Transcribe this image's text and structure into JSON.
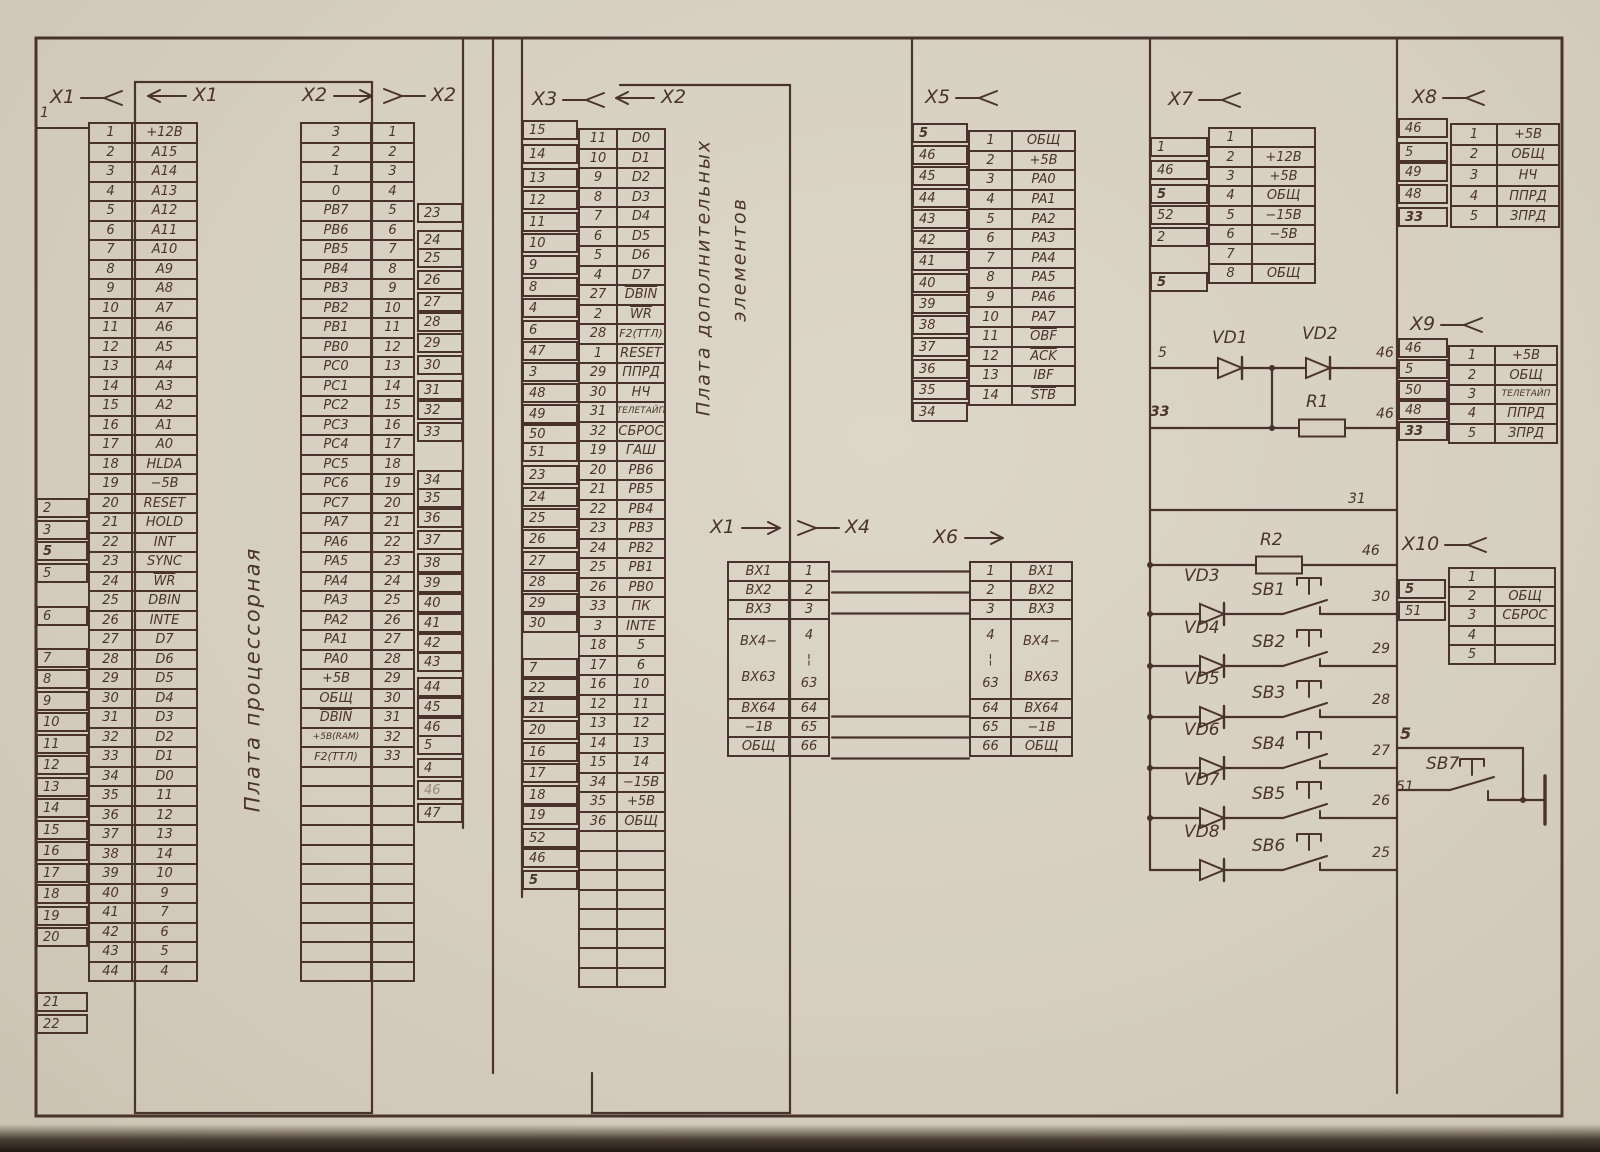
{
  "page": {
    "ink": "#4a332c",
    "paper": "#d8d1c2"
  },
  "boards": {
    "b1": "Плата  процессорная",
    "b2a": "Плата  дополнительных",
    "b2b": "элементов"
  },
  "headers": {
    "x1_out": "X1",
    "x1_in": "X1",
    "x2_in": "X2",
    "x2_mate": "X2",
    "x3_out": "X3",
    "x3_in": "X2",
    "x5": "X5",
    "x7": "X7",
    "x8": "X8",
    "x9": "X9",
    "x10": "X10",
    "x4_src": "X1",
    "x4_mate": "X4",
    "x6": "X6"
  },
  "connectors": {
    "x1": {
      "edge_top": "1",
      "edges": [
        "2",
        "3",
        "*5",
        "5",
        "6",
        "7",
        "8",
        "9",
        "10",
        "11",
        "12",
        "13",
        "14",
        "15",
        "16",
        "17",
        "18",
        "19",
        "20",
        "21",
        "22"
      ],
      "rows": [
        [
          "1",
          "+12В"
        ],
        [
          "2",
          "A15"
        ],
        [
          "3",
          "A14"
        ],
        [
          "4",
          "A13"
        ],
        [
          "5",
          "A12"
        ],
        [
          "6",
          "A11"
        ],
        [
          "7",
          "A10"
        ],
        [
          "8",
          "A9"
        ],
        [
          "9",
          "A8"
        ],
        [
          "10",
          "A7"
        ],
        [
          "11",
          "A6"
        ],
        [
          "12",
          "A5"
        ],
        [
          "13",
          "A4"
        ],
        [
          "14",
          "A3"
        ],
        [
          "15",
          "A2"
        ],
        [
          "16",
          "A1"
        ],
        [
          "17",
          "A0"
        ],
        [
          "18",
          "HLDA"
        ],
        [
          "19",
          "−5В"
        ],
        [
          "20",
          "RESET"
        ],
        [
          "21",
          "HOLD"
        ],
        [
          "22",
          "INT"
        ],
        [
          "23",
          "SYNC"
        ],
        [
          "24",
          "^WR"
        ],
        [
          "25",
          "DBIN"
        ],
        [
          "26",
          "INTE"
        ],
        [
          "27",
          "D7"
        ],
        [
          "28",
          "D6"
        ],
        [
          "29",
          "D5"
        ],
        [
          "30",
          "D4"
        ],
        [
          "31",
          "D3"
        ],
        [
          "32",
          "D2"
        ],
        [
          "33",
          "D1"
        ],
        [
          "34",
          "D0"
        ],
        [
          "35",
          "11"
        ],
        [
          "36",
          "12"
        ],
        [
          "37",
          "13"
        ],
        [
          "38",
          "14"
        ],
        [
          "39",
          "10"
        ],
        [
          "40",
          "9"
        ],
        [
          "41",
          "7"
        ],
        [
          "42",
          "6"
        ],
        [
          "43",
          "5"
        ],
        [
          "44",
          "4"
        ]
      ]
    },
    "x2": {
      "edges": [
        "23",
        "24",
        "25",
        "26",
        "27",
        "28",
        "29",
        "30",
        "31",
        "32",
        "33",
        "34",
        "35",
        "36",
        "37",
        "38",
        "39",
        "40",
        "41",
        "42",
        "43",
        "44",
        "45",
        "46",
        "5",
        "4",
        "~46",
        "47"
      ],
      "rows": [
        [
          "3",
          "1"
        ],
        [
          "2",
          "2"
        ],
        [
          "1",
          "3"
        ],
        [
          "0",
          "4"
        ],
        [
          "PB7",
          "5"
        ],
        [
          "PB6",
          "6"
        ],
        [
          "PB5",
          "7"
        ],
        [
          "PB4",
          "8"
        ],
        [
          "PB3",
          "9"
        ],
        [
          "PB2",
          "10"
        ],
        [
          "PB1",
          "11"
        ],
        [
          "PB0",
          "12"
        ],
        [
          "PC0",
          "13"
        ],
        [
          "PC1",
          "14"
        ],
        [
          "PC2",
          "15"
        ],
        [
          "PC3",
          "16"
        ],
        [
          "PC4",
          "17"
        ],
        [
          "PC5",
          "18"
        ],
        [
          "PC6",
          "19"
        ],
        [
          "PC7",
          "20"
        ],
        [
          "PA7",
          "21"
        ],
        [
          "PA6",
          "22"
        ],
        [
          "PA5",
          "23"
        ],
        [
          "PA4",
          "24"
        ],
        [
          "PA3",
          "25"
        ],
        [
          "PA2",
          "26"
        ],
        [
          "PA1",
          "27"
        ],
        [
          "PA0",
          "28"
        ],
        [
          "+5В",
          "29"
        ],
        [
          "ОБЩ",
          "30"
        ],
        [
          "^DBIN",
          "31"
        ],
        [
          "+5В(RAM)",
          "32"
        ],
        [
          "F2(ТТЛ)",
          "33"
        ]
      ]
    },
    "x3": {
      "edges": [
        "15",
        "14",
        "13",
        "12",
        "11",
        "10",
        "9",
        "8",
        "4",
        "6",
        "47",
        "3",
        "48",
        "49",
        "50",
        "51",
        "23",
        "24",
        "25",
        "26",
        "27",
        "28",
        "29",
        "30",
        "7",
        "22",
        "21",
        "20",
        "16",
        "17",
        "18",
        "19",
        "52",
        "46",
        "*5"
      ],
      "rows": [
        [
          "11",
          "D0"
        ],
        [
          "10",
          "D1"
        ],
        [
          "9",
          "D2"
        ],
        [
          "8",
          "D3"
        ],
        [
          "7",
          "D4"
        ],
        [
          "6",
          "D5"
        ],
        [
          "5",
          "D6"
        ],
        [
          "4",
          "D7"
        ],
        [
          "27",
          "^DBIN"
        ],
        [
          "2",
          "^WR"
        ],
        [
          "28",
          "F2(ТТЛ)"
        ],
        [
          "1",
          "RESET"
        ],
        [
          "29",
          "ППРД"
        ],
        [
          "30",
          "НЧ"
        ],
        [
          "31",
          "ТЕЛЕТАЙП"
        ],
        [
          "32",
          "СБРОС"
        ],
        [
          "19",
          "ГАШ"
        ],
        [
          "20",
          "PB6"
        ],
        [
          "21",
          "PB5"
        ],
        [
          "22",
          "PB4"
        ],
        [
          "23",
          "PB3"
        ],
        [
          "24",
          "PB2"
        ],
        [
          "25",
          "PB1"
        ],
        [
          "26",
          "PB0"
        ],
        [
          "33",
          "ПК"
        ],
        [
          "3",
          "INTE"
        ],
        [
          "18",
          "5"
        ],
        [
          "17",
          "6"
        ],
        [
          "16",
          "10"
        ],
        [
          "12",
          "11"
        ],
        [
          "13",
          "12"
        ],
        [
          "14",
          "13"
        ],
        [
          "15",
          "14"
        ],
        [
          "34",
          "−15В"
        ],
        [
          "35",
          "+5В"
        ],
        [
          "36",
          "ОБЩ"
        ]
      ]
    },
    "x4": {
      "rows": [
        [
          "ВХ1",
          "1"
        ],
        [
          "ВХ2",
          "2"
        ],
        [
          "ВХ3",
          "3"
        ],
        [
          "ВХ4−|ВХ63",
          "4|¦|63"
        ],
        [
          "ВХ64",
          "64"
        ],
        [
          "−1В",
          "65"
        ],
        [
          "ОБЩ",
          "66"
        ]
      ]
    },
    "x5": {
      "edges": [
        "*5",
        "46",
        "45",
        "44",
        "43",
        "42",
        "41",
        "40",
        "39",
        "38",
        "37",
        "36",
        "35",
        "34"
      ],
      "rows": [
        [
          "1",
          "ОБЩ"
        ],
        [
          "2",
          "+5В"
        ],
        [
          "3",
          "PA0"
        ],
        [
          "4",
          "PA1"
        ],
        [
          "5",
          "PA2"
        ],
        [
          "6",
          "PA3"
        ],
        [
          "7",
          "PA4"
        ],
        [
          "8",
          "PA5"
        ],
        [
          "9",
          "PA6"
        ],
        [
          "10",
          "PA7"
        ],
        [
          "11",
          "^OBF"
        ],
        [
          "12",
          "^ACK"
        ],
        [
          "13",
          "IBF"
        ],
        [
          "14",
          "^STB"
        ]
      ]
    },
    "x6": {
      "rows": [
        [
          "1",
          "ВХ1"
        ],
        [
          "2",
          "ВХ2"
        ],
        [
          "3",
          "ВХ3"
        ],
        [
          "4|¦|63",
          "ВХ4−|ВХ63"
        ],
        [
          "64",
          "ВХ64"
        ],
        [
          "65",
          "−1В"
        ],
        [
          "66",
          "ОБЩ"
        ]
      ]
    },
    "x7": {
      "edges": [
        "1",
        "46",
        "*5",
        "52",
        "2",
        "*5"
      ],
      "rows": [
        [
          "1",
          ""
        ],
        [
          "2",
          "+12В"
        ],
        [
          "3",
          "+5В"
        ],
        [
          "4",
          "ОБЩ"
        ],
        [
          "5",
          "−15В"
        ],
        [
          "6",
          "−5В"
        ],
        [
          "7",
          ""
        ],
        [
          "8",
          "ОБЩ"
        ]
      ]
    },
    "x8": {
      "edges": [
        "46",
        "5",
        "49",
        "48",
        "*33"
      ],
      "rows": [
        [
          "1",
          "+5В"
        ],
        [
          "2",
          "ОБЩ"
        ],
        [
          "3",
          "НЧ"
        ],
        [
          "4",
          "ППРД"
        ],
        [
          "5",
          "ЗПРД"
        ]
      ]
    },
    "x9": {
      "edges": [
        "46",
        "5",
        "50",
        "48",
        "*33"
      ],
      "rows": [
        [
          "1",
          "+5В"
        ],
        [
          "2",
          "ОБЩ"
        ],
        [
          "3",
          "ТЕЛЕТАЙП"
        ],
        [
          "4",
          "ППРД"
        ],
        [
          "5",
          "ЗПРД"
        ]
      ]
    },
    "x10": {
      "edges": [
        "*5",
        "51"
      ],
      "rows": [
        [
          "1",
          ""
        ],
        [
          "2",
          "ОБЩ"
        ],
        [
          "3",
          "СБРОС"
        ],
        [
          "4",
          ""
        ],
        [
          "5",
          ""
        ]
      ]
    }
  },
  "components": {
    "vd1": "VD1",
    "vd2": "VD2",
    "r1": "R1",
    "r2": "R2",
    "sb7": "SB7"
  },
  "wire_labels": {
    "x7_out": "5",
    "x7_low": "33",
    "vd_out": "46",
    "r1_out": "46",
    "bus_top": "31",
    "r2_out": "46",
    "sb7_top": "5",
    "sb7_left": "51"
  },
  "branches": [
    {
      "vd": "VD3",
      "sb": "SB1",
      "pin": "30"
    },
    {
      "vd": "VD4",
      "sb": "SB2",
      "pin": "29"
    },
    {
      "vd": "VD5",
      "sb": "SB3",
      "pin": "28"
    },
    {
      "vd": "VD6",
      "sb": "SB4",
      "pin": "27"
    },
    {
      "vd": "VD7",
      "sb": "SB5",
      "pin": "26"
    },
    {
      "vd": "VD8",
      "sb": "SB6",
      "pin": "25"
    }
  ]
}
